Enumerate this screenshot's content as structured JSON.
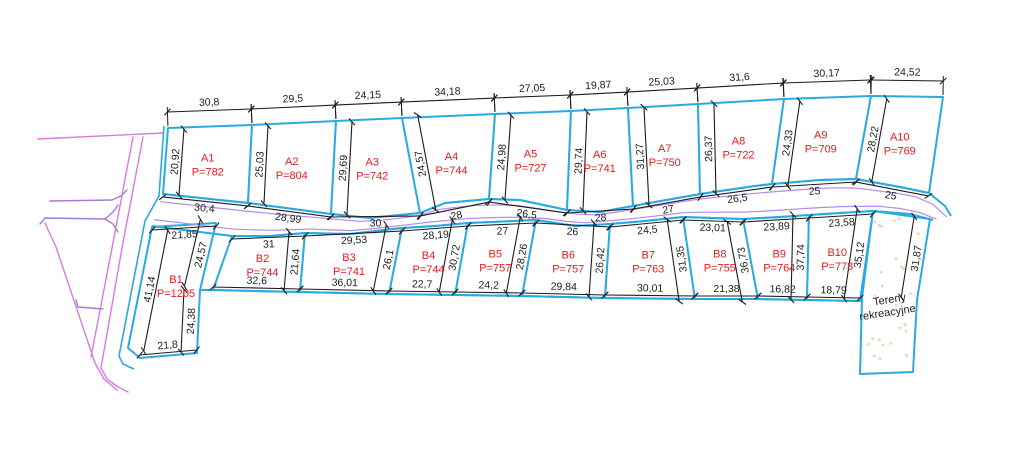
{
  "colors": {
    "boundary_cyan": "#29abe2",
    "dim_black": "#1c1c1c",
    "label_red": "#e8191d",
    "road_magenta": "#d97be3",
    "road_violet": "#a878dd",
    "road_center_purple": "#b58be8",
    "recreation_dots": "#f4d4b4"
  },
  "row_a": {
    "plots": [
      {
        "name": "A1",
        "area": "P=782"
      },
      {
        "name": "A2",
        "area": "P=804"
      },
      {
        "name": "A3",
        "area": "P=742"
      },
      {
        "name": "A4",
        "area": "P=744"
      },
      {
        "name": "A5",
        "area": "P=727"
      },
      {
        "name": "A6",
        "area": "P=741"
      },
      {
        "name": "A7",
        "area": "P=750"
      },
      {
        "name": "A8",
        "area": "P=722"
      },
      {
        "name": "A9",
        "area": "P=709"
      },
      {
        "name": "A10",
        "area": "P=769"
      }
    ],
    "top_dims": [
      "30,8",
      "29,5",
      "24,15",
      "34,18",
      "27,05",
      "19,87",
      "25,03",
      "31,6",
      "30,17",
      "24,52"
    ],
    "bottom_dims": [
      "30,4",
      "28,99",
      "30",
      "28",
      "26,5",
      "28",
      "27",
      "26,5",
      "25",
      "25"
    ],
    "side_dims": [
      "20,92",
      "25,03",
      "29,69",
      "24,57",
      "24,98",
      "29,74",
      "31,27",
      "26,37",
      "24,33",
      "28,22"
    ],
    "top_pts": [
      [
        168,
        128
      ],
      [
        252,
        125
      ],
      [
        336,
        121
      ],
      [
        402,
        118
      ],
      [
        495,
        114
      ],
      [
        571,
        111
      ],
      [
        628,
        108
      ],
      [
        698,
        104
      ],
      [
        784,
        99
      ],
      [
        871,
        96
      ],
      [
        943,
        97
      ]
    ],
    "road_top": [
      [
        163,
        194
      ],
      [
        248,
        203
      ],
      [
        331,
        214
      ],
      [
        370,
        218
      ],
      [
        420,
        213
      ],
      [
        445,
        203
      ],
      [
        489,
        199
      ],
      [
        520,
        200
      ],
      [
        567,
        210
      ],
      [
        600,
        212
      ],
      [
        633,
        206
      ],
      [
        700,
        194
      ],
      [
        755,
        186
      ],
      [
        772,
        184
      ],
      [
        820,
        180
      ],
      [
        856,
        179
      ],
      [
        900,
        187
      ],
      [
        929,
        193
      ],
      [
        945,
        206
      ],
      [
        951,
        216
      ]
    ],
    "divider_idx": [
      0,
      1,
      2,
      4,
      6,
      8,
      10,
      11,
      13,
      15,
      17
    ]
  },
  "row_b": {
    "plots": [
      {
        "name": "B2",
        "area": "P=744"
      },
      {
        "name": "B3",
        "area": "P=741"
      },
      {
        "name": "B4",
        "area": "P=744"
      },
      {
        "name": "B5",
        "area": "P=757"
      },
      {
        "name": "B6",
        "area": "P=757"
      },
      {
        "name": "B7",
        "area": "P=763"
      },
      {
        "name": "B8",
        "area": "P=755"
      },
      {
        "name": "B9",
        "area": "P=764"
      },
      {
        "name": "B10",
        "area": "P=778"
      }
    ],
    "top_dims": [
      "31",
      "29,53",
      "28,19",
      "27",
      "26",
      "24,5",
      "23,01",
      "23,89",
      "23,58"
    ],
    "bottom_dims": [
      "32,6",
      "36,01",
      "22,7",
      "24,2",
      "29,84",
      "30,01",
      "21,38",
      "16,82",
      "18,79"
    ],
    "side_dims": [
      "21,64",
      "26,1",
      "30,72",
      "28,26",
      "26,42",
      "31,35",
      "36,73",
      "37,74",
      "35,12"
    ],
    "top_pts": [
      [
        232,
        236
      ],
      [
        305,
        233
      ],
      [
        402,
        228
      ],
      [
        468,
        223
      ],
      [
        536,
        220
      ],
      [
        610,
        224
      ],
      [
        683,
        217
      ],
      [
        743,
        219
      ],
      [
        809,
        215
      ],
      [
        873,
        211
      ]
    ],
    "bottom_pts": [
      [
        213,
        290
      ],
      [
        300,
        292
      ],
      [
        389,
        294
      ],
      [
        455,
        295
      ],
      [
        522,
        296
      ],
      [
        605,
        298
      ],
      [
        695,
        299
      ],
      [
        758,
        299
      ],
      [
        807,
        300
      ],
      [
        860,
        301
      ]
    ],
    "road_bottom": [
      [
        152,
        226
      ],
      [
        232,
        236
      ],
      [
        270,
        236
      ],
      [
        305,
        233
      ],
      [
        350,
        234
      ],
      [
        402,
        228
      ],
      [
        435,
        226
      ],
      [
        468,
        223
      ],
      [
        536,
        220
      ],
      [
        575,
        226
      ],
      [
        610,
        224
      ],
      [
        645,
        221
      ],
      [
        683,
        217
      ],
      [
        743,
        219
      ],
      [
        780,
        217
      ],
      [
        809,
        215
      ],
      [
        840,
        213
      ],
      [
        873,
        211
      ],
      [
        910,
        214
      ],
      [
        933,
        220
      ]
    ],
    "divider_idx": [
      1,
      3,
      5,
      7,
      8,
      10,
      12,
      13,
      15,
      17
    ]
  },
  "plot_b1": {
    "name": "B1",
    "area": "P=1205",
    "points": [
      [
        152,
        227
      ],
      [
        216,
        223
      ],
      [
        200,
        290
      ],
      [
        197,
        353
      ],
      [
        140,
        358
      ],
      [
        128,
        348
      ]
    ],
    "dims": {
      "top": "21,85",
      "right_upper": "24,57",
      "right_lower": "24,38",
      "bottom": "21,8",
      "left": "41,14"
    }
  },
  "recreation": {
    "label_line1": "Tereny",
    "label_line2": "rekreacyjne",
    "side_dim": "31,87",
    "points": [
      [
        873,
        211
      ],
      [
        930,
        219
      ],
      [
        917,
        300
      ],
      [
        913,
        372
      ],
      [
        860,
        374
      ],
      [
        862,
        298
      ]
    ]
  },
  "roads": {
    "west_lines": [
      {
        "c": "magenta",
        "pts": [
          [
            38,
            139
          ],
          [
            163,
            133
          ]
        ]
      },
      {
        "c": "magenta",
        "pts": [
          [
            133,
            137
          ],
          [
            112,
            248
          ],
          [
            91,
            357
          ]
        ]
      },
      {
        "c": "magenta",
        "pts": [
          [
            143,
            137
          ],
          [
            122,
            248
          ],
          [
            101,
            368
          ],
          [
            107,
            379
          ],
          [
            118,
            387
          ],
          [
            128,
            392
          ]
        ]
      },
      {
        "c": "violet",
        "pts": [
          [
            50,
            201
          ],
          [
            112,
            200
          ],
          [
            121,
            196
          ],
          [
            127,
            190
          ]
        ]
      },
      {
        "c": "violet",
        "pts": [
          [
            40,
            224
          ],
          [
            45,
            218
          ],
          [
            105,
            219
          ],
          [
            113,
            224
          ],
          [
            118,
            232
          ]
        ]
      },
      {
        "c": "violet",
        "pts": [
          [
            105,
            219
          ],
          [
            113,
            212
          ],
          [
            118,
            205
          ]
        ]
      },
      {
        "c": "magenta",
        "pts": [
          [
            45,
            223
          ],
          [
            56,
            247
          ],
          [
            95,
            363
          ],
          [
            104,
            379
          ],
          [
            117,
            390
          ]
        ]
      },
      {
        "c": "violet",
        "pts": [
          [
            76,
            300
          ],
          [
            78,
            307
          ],
          [
            103,
            309
          ]
        ]
      }
    ],
    "west_boundary_cyan": [
      [
        164,
        126
      ],
      [
        159,
        196
      ],
      [
        145,
        221
      ],
      [
        119,
        356
      ],
      [
        123,
        364
      ],
      [
        134,
        369
      ]
    ]
  }
}
